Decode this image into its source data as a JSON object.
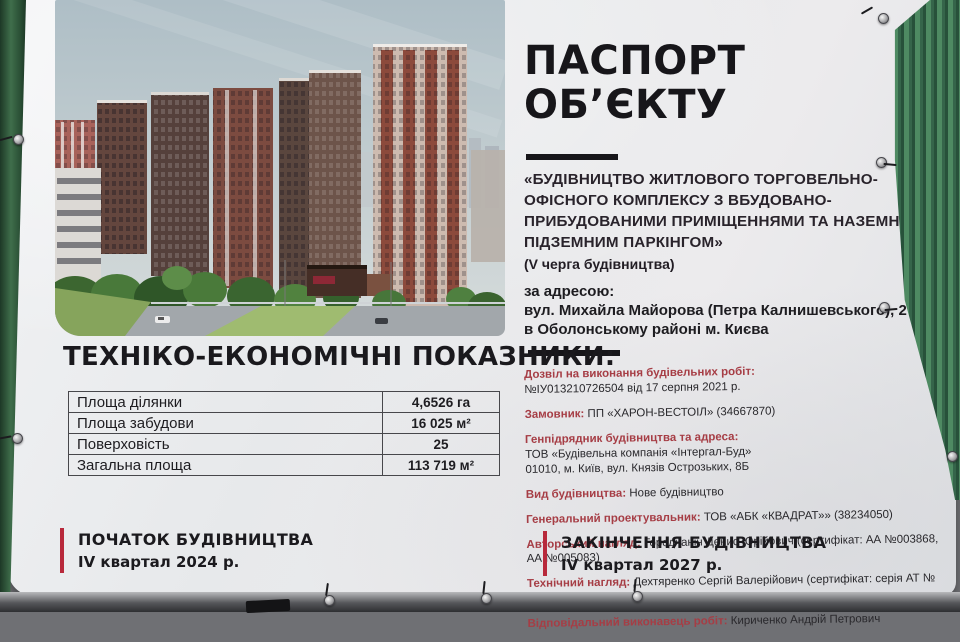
{
  "banner": {
    "title_line1": "ПАСПОРТ",
    "title_line2": "ОБ’ЄКТУ",
    "object_description": "«БУДІВНИЦТВО ЖИТЛОВОГО ТОРГОВЕЛЬНО-ОФІСНОГО КОМПЛЕКСУ З ВБУДОВАНО-ПРИБУДОВАНИМИ ПРИМІЩЕННЯМИ ТА НАЗЕМНО-ПІДЗЕМНИМ ПАРКІНГОМ»",
    "phase": "(V черга будівництва)",
    "address_intro": "за адресою:",
    "address_line1": "вул. Михайла Майорова (Петра Калнишевського), 2",
    "address_line2": "в Оболонському районі м. Києва"
  },
  "details": {
    "items": [
      {
        "label": "Дозвіл на виконання будівельних робіт:",
        "line1": "№ІУ013210726504 від 17 серпня 2021 р."
      },
      {
        "label": "Замовник:",
        "value": "ПП «ХАРОН-ВЕСТОІЛ» (34667870)"
      },
      {
        "label": "Генпідрядник будівництва та адреса:",
        "line1": "ТОВ «Будівельна компанія «Інтергал-Буд»",
        "line2": "01010, м. Київ, вул. Князів Острозьких, 8Б"
      },
      {
        "label": "Вид будівництва:",
        "value": "Нове будівництво"
      },
      {
        "label": "Генеральний проектувальник:",
        "value": "ТОВ «АБК «КВАДРАТ»» (38234050)"
      },
      {
        "label": "Авторський нагляд:",
        "value": "Городчанін Денис Юрійович (сертифікат: АА №003868, АА №005083)"
      },
      {
        "label": "Технічний нагляд:",
        "value": "Дехтяренко Сергій Валерійович (сертифікат: серія АТ № 009071)"
      },
      {
        "label": "Відповідальний виконавець робіт:",
        "value": "Кириченко Андрій Петрович"
      }
    ]
  },
  "indicators": {
    "title": "ТЕХНІКО-ЕКОНОМІЧНІ ПОКАЗНИКИ:",
    "rows": [
      {
        "label": "Площа ділянки",
        "value": "4,6526 га"
      },
      {
        "label": "Площа забудови",
        "value": "16 025 м²"
      },
      {
        "label": "Поверховість",
        "value": "25"
      },
      {
        "label": "Загальна площа",
        "value": "113 719 м²"
      }
    ]
  },
  "timeline": {
    "start": {
      "title": "ПОЧАТОК БУДІВНИЦТВА",
      "date": "IV квартал 2024 р."
    },
    "end": {
      "title": "ЗАКІНЧЕННЯ БУДІВНИЦТВА",
      "date": "IV квартал 2027 р."
    }
  },
  "colors": {
    "accent_red": "#b8293b",
    "label_red": "#a63d45",
    "text_dark": "#17161a",
    "fence_green": "#3f6e4b",
    "banner_bg": "#e9eaec"
  }
}
